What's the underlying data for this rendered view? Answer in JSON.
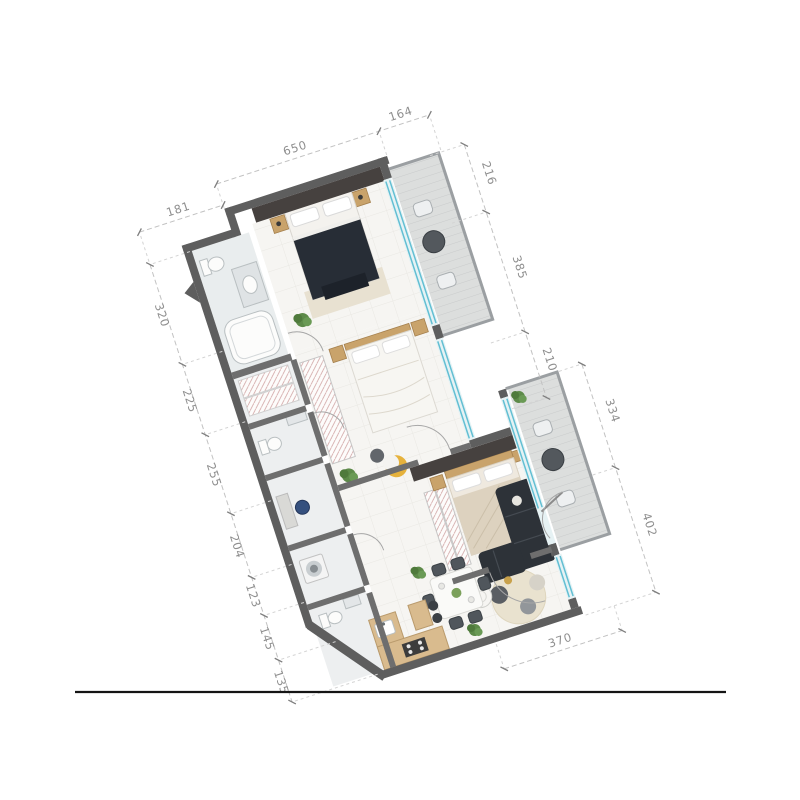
{
  "page": {
    "background": "#ffffff",
    "type": "architectural-floor-plan-render"
  },
  "floorplan": {
    "view": "top-down 2D apartment floor plan, rotated",
    "dimensions": {
      "top_setback": "181",
      "top": "650",
      "top_right": "164",
      "left": [
        "320",
        "225",
        "255",
        "204",
        "123",
        "145",
        "135"
      ],
      "right_outer_upper": [
        "216",
        "385",
        "210"
      ],
      "right_outer_lower": [
        "334",
        "402"
      ],
      "bottom": "370"
    },
    "rooms": [
      "bathroom",
      "master-bedroom",
      "upper-balcony",
      "bedroom-2",
      "wc",
      "utility-room",
      "laundry",
      "entry-hall",
      "bedroom-3",
      "lower-balcony",
      "living-room",
      "dining-area",
      "kitchen"
    ],
    "colors": {
      "exterior_wall": "#5e5e5e",
      "interior_wall": "#6e6e6e",
      "accent_wall": "#46413f",
      "window_glass": "#62bfd3",
      "floor_tile": "#f6f5f2",
      "balcony_floor": "#dcdedd",
      "wood": "#c9a36b",
      "dark_bed": "#272d36",
      "beige_bed": "#ddd2bf",
      "sofa": "#2d3238",
      "plant": "#5d8a49",
      "crescent_chair": "#e6b23c",
      "dimension_text": "#8e8e8e"
    }
  },
  "footer": {
    "divider": "horizontal rule"
  }
}
